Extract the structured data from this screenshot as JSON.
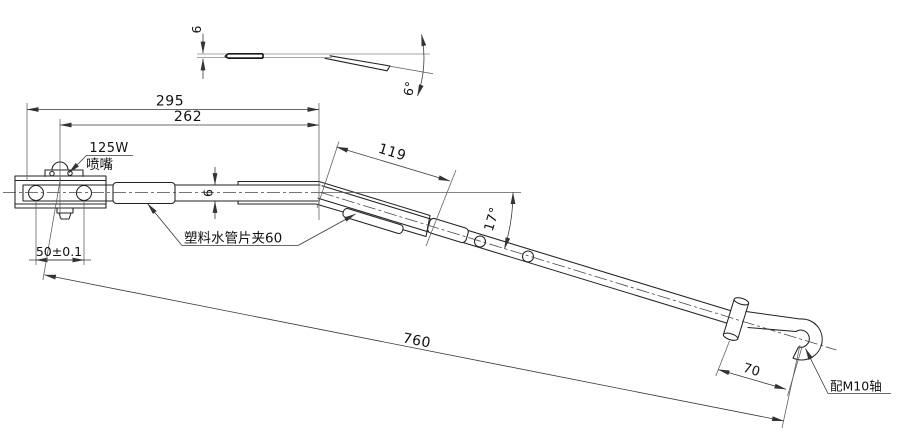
{
  "title": "Wiper arm engineering drawing",
  "colors": {
    "background": "#ffffff",
    "line": "#222222",
    "dim_line": "#3a3a3a",
    "text": "#111111"
  },
  "dimensions": {
    "overall_top": "295",
    "inner_top": "262",
    "bend_section": "119",
    "bend_angle": "17°",
    "total_length": "760",
    "hook_section": "70",
    "hole_spacing": "50±0.1",
    "arm_height": "6",
    "profile_thickness": "6",
    "profile_angle": "6°"
  },
  "annotations": {
    "nozzle_spec": "125W",
    "nozzle_name": "喷嘴",
    "clip_note": "塑料水管片夹60",
    "shaft_note": "配M10轴"
  }
}
